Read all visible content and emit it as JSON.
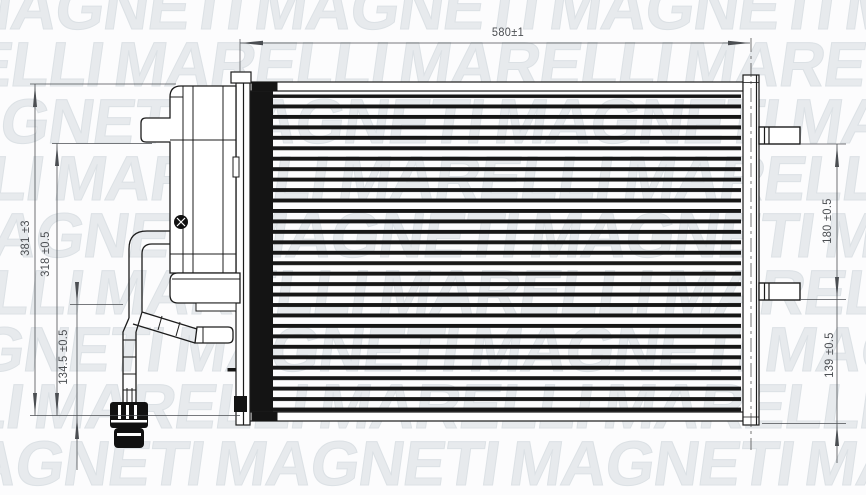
{
  "watermark": {
    "words": [
      "MAGNETI",
      "MARELLI"
    ]
  },
  "dimensions": {
    "top_width": "580±1",
    "left_overall_height": "381 ±3",
    "left_upper_height": "318 ±0.5",
    "left_lower_height": "134.5 ±0.5",
    "right_port_spacing": "180 ±0.5",
    "right_lower_port": "139 ±0.5"
  },
  "colors": {
    "line": "#1c1c1c",
    "dimension": "#4b4e52",
    "watermark": "#e7eaed",
    "background": "#fcfcfd"
  }
}
